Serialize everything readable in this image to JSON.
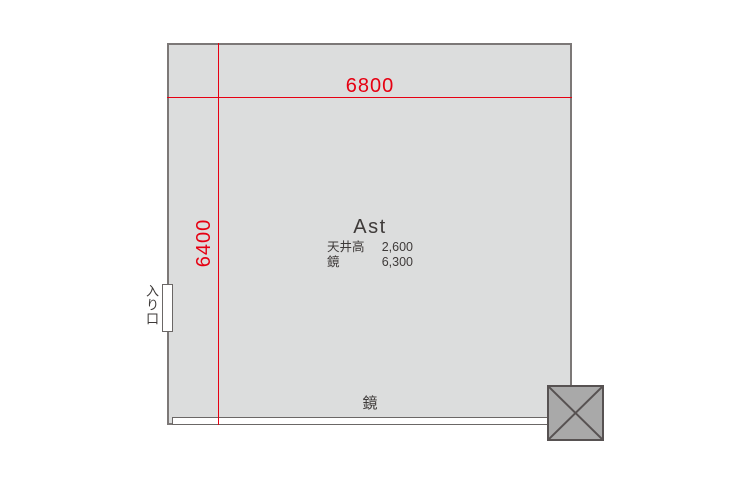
{
  "room": {
    "name": "Ast",
    "width_dim": "6800",
    "height_dim": "6400",
    "specs": [
      {
        "label": "天井高",
        "value": "2,600"
      },
      {
        "label": "鏡",
        "value": "6,300"
      }
    ],
    "mirror_label": "鏡",
    "entrance_label": "入り口"
  },
  "colors": {
    "dimension_red": "#e60012",
    "room_fill": "#dcdddd",
    "wall_gray": "#7c7877",
    "pillar_fill": "#a9a9a9",
    "text_dark": "#3e3a39"
  }
}
